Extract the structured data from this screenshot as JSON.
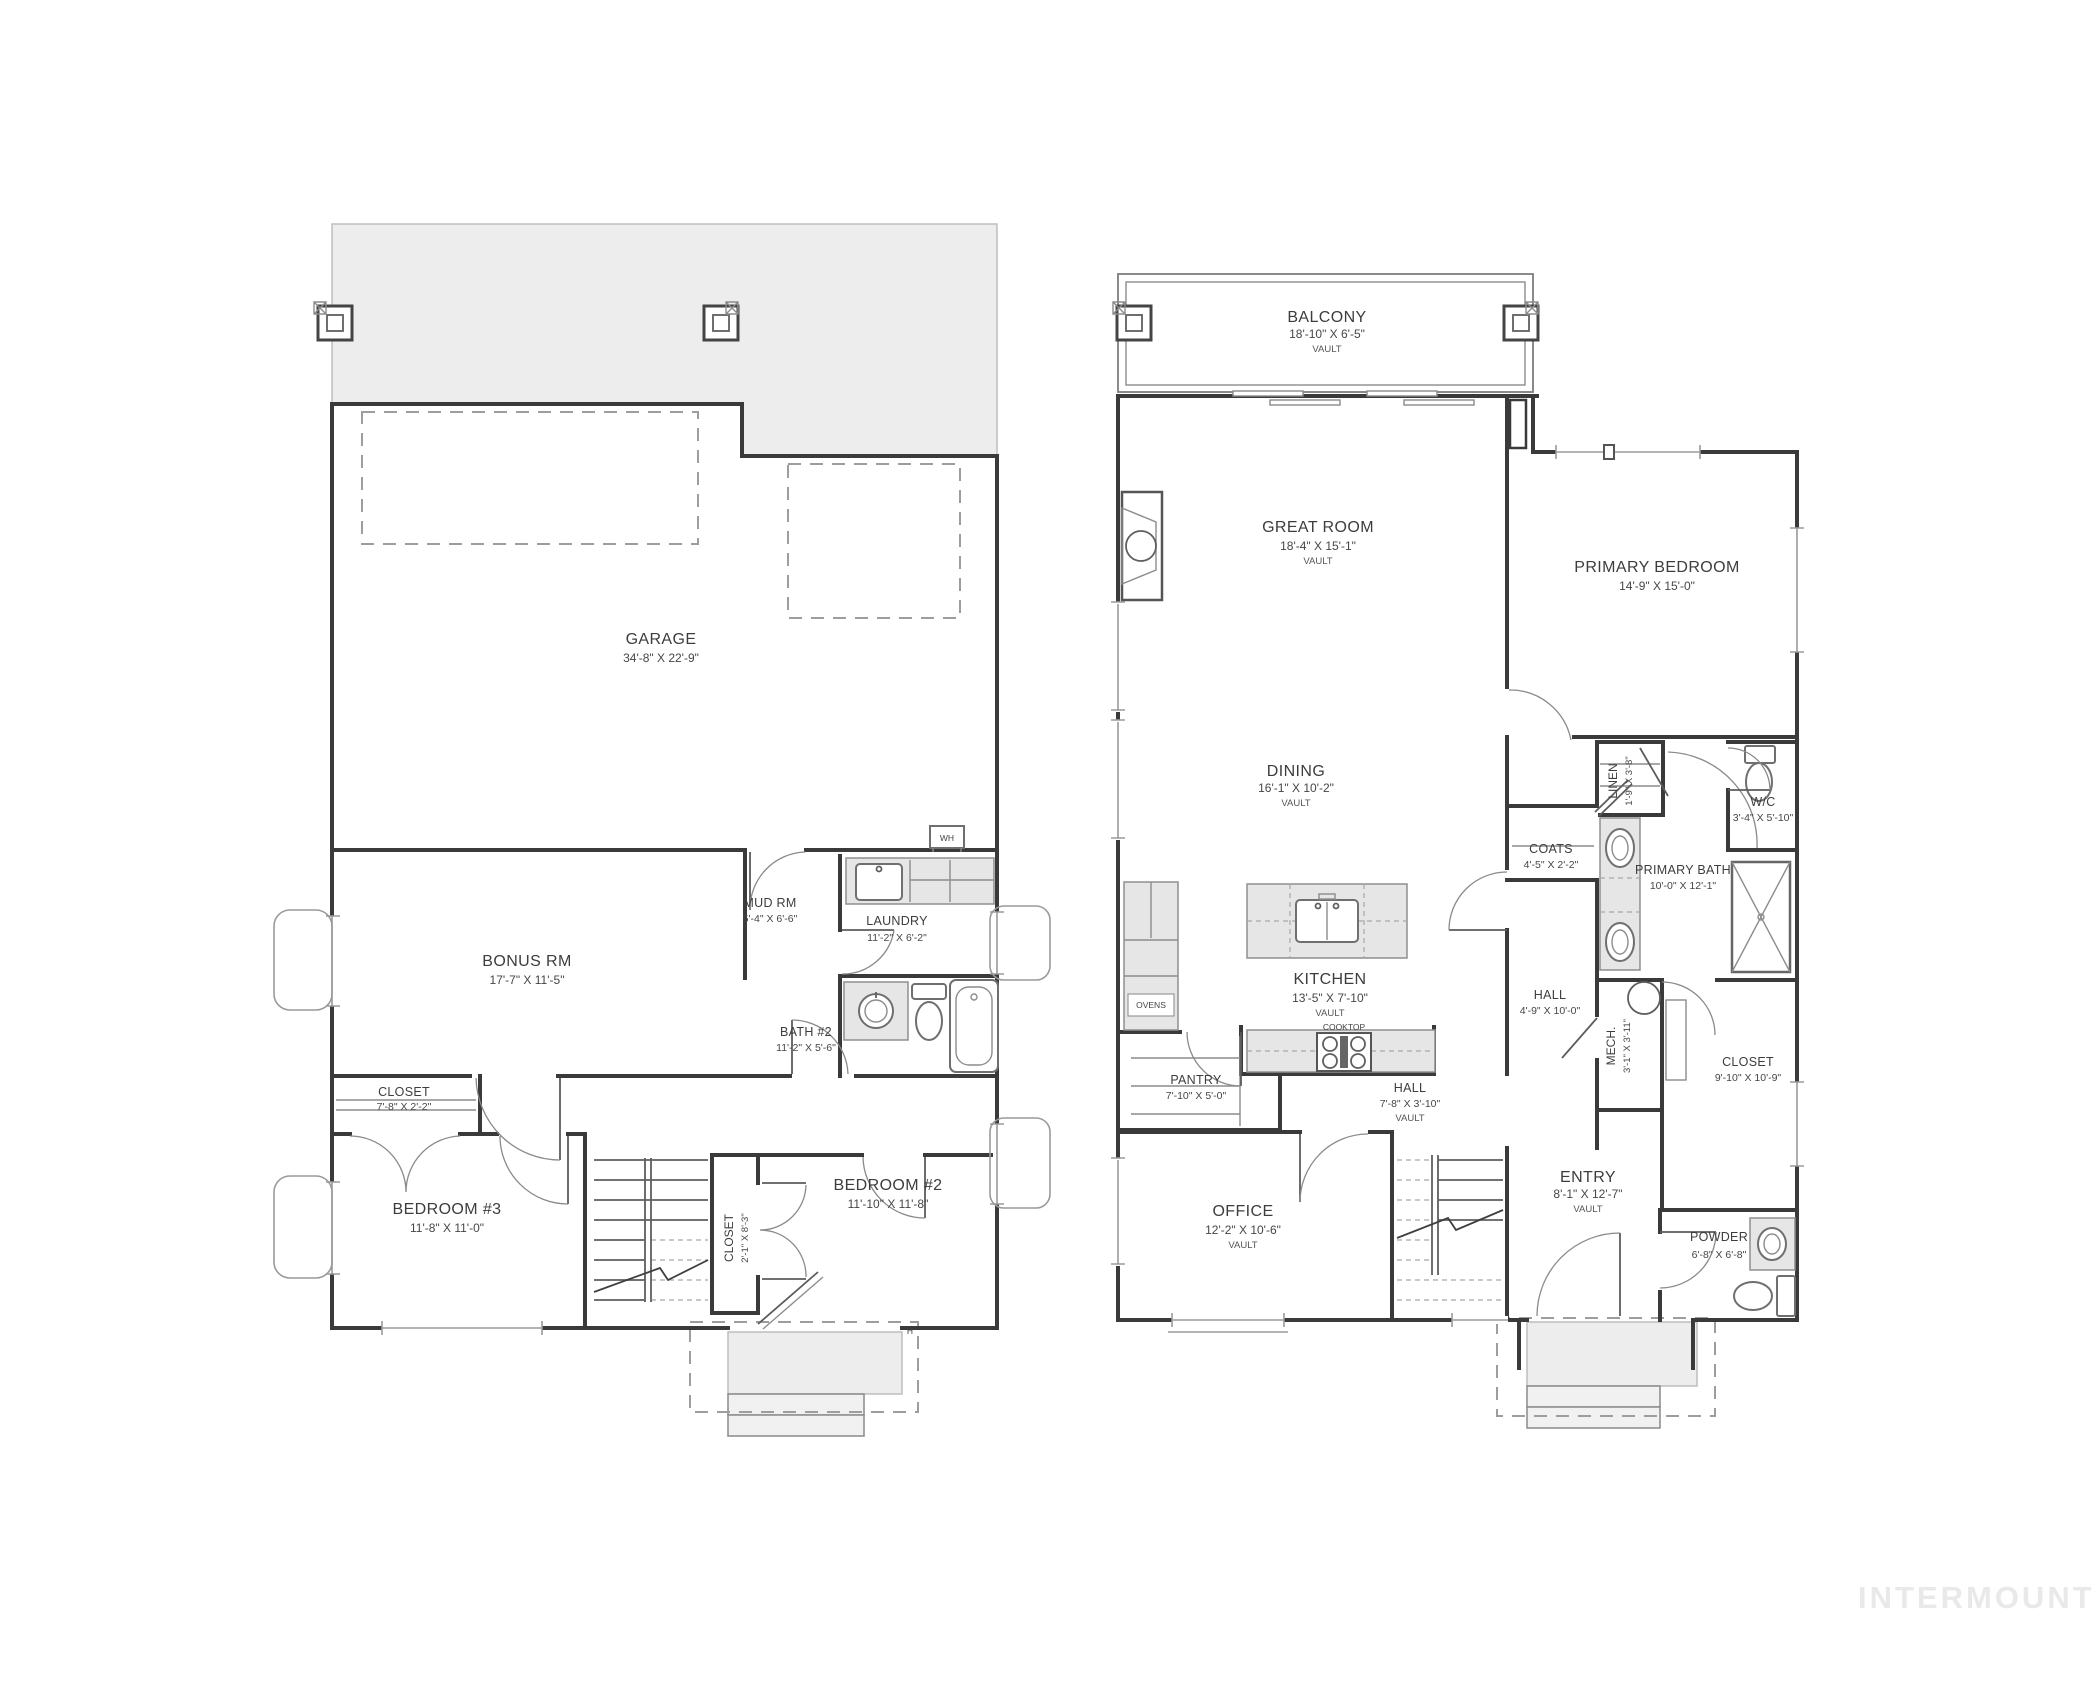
{
  "watermark": "INTERMOUNTAIN",
  "floor1": {
    "garage": {
      "label": "GARAGE",
      "dims": "34'-8\" X 22'-9\""
    },
    "bonus": {
      "label": "BONUS RM",
      "dims": "17'-7\" X 11'-5\""
    },
    "mud": {
      "label": "MUD RM",
      "dims": "5'-4\" X 6'-6\""
    },
    "laundry": {
      "label": "LAUNDRY",
      "dims": "11'-2\" X 6'-2\""
    },
    "bath2": {
      "label": "BATH #2",
      "dims": "11'-2\" X 5'-6\""
    },
    "closet_b3": {
      "label": "CLOSET",
      "dims": "7'-8\" X 2'-2\""
    },
    "bedroom3": {
      "label": "BEDROOM #3",
      "dims": "11'-8\" X 11'-0\""
    },
    "closet_b2": {
      "label": "CLOSET",
      "dims": "2'-1\" X 8'-3\""
    },
    "bedroom2": {
      "label": "BEDROOM #2",
      "dims": "11'-10\" X 11'-8\""
    },
    "wh": "WH",
    "hose_marker": "H"
  },
  "floor2": {
    "balcony": {
      "label": "BALCONY",
      "dims": "18'-10\" X 6'-5\"",
      "note": "VAULT"
    },
    "great": {
      "label": "GREAT ROOM",
      "dims": "18'-4\" X 15'-1\"",
      "note": "VAULT"
    },
    "primary_bedroom": {
      "label": "PRIMARY BEDROOM",
      "dims": "14'-9\" X 15'-0\""
    },
    "dining": {
      "label": "DINING",
      "dims": "16'-1\" X 10'-2\"",
      "note": "VAULT"
    },
    "linen": {
      "label": "LINEN",
      "dims": "1'-9\" X 3'-8\""
    },
    "wc": {
      "label": "W/C",
      "dims": "3'-4\" X 5'-10\""
    },
    "coats": {
      "label": "COATS",
      "dims": "4'-5\" X 2'-2\""
    },
    "primary_bath": {
      "label": "PRIMARY BATH",
      "dims": "10'-0\" X 12'-1\""
    },
    "kitchen": {
      "label": "KITCHEN",
      "dims": "13'-5\" X 7'-10\"",
      "note": "VAULT"
    },
    "ovens": "OVENS",
    "cooktop": "COOKTOP",
    "hall_upper": {
      "label": "HALL",
      "dims": "4'-9\" X 10'-0\""
    },
    "mech": {
      "label": "MECH.",
      "dims": "3'-1\" X 3'-11\""
    },
    "closet_primary": {
      "label": "CLOSET",
      "dims": "9'-10\" X 10'-9\""
    },
    "pantry": {
      "label": "PANTRY",
      "dims": "7'-10\" X 5'-0\""
    },
    "hall_lower": {
      "label": "HALL",
      "dims": "7'-8\" X 3'-10\"",
      "note": "VAULT"
    },
    "office": {
      "label": "OFFICE",
      "dims": "12'-2\" X 10'-6\"",
      "note": "VAULT"
    },
    "entry": {
      "label": "ENTRY",
      "dims": "8'-1\" X 12'-7\"",
      "note": "VAULT"
    },
    "powder": {
      "label": "POWDER",
      "dims": "6'-8\" X 6'-8\""
    }
  }
}
